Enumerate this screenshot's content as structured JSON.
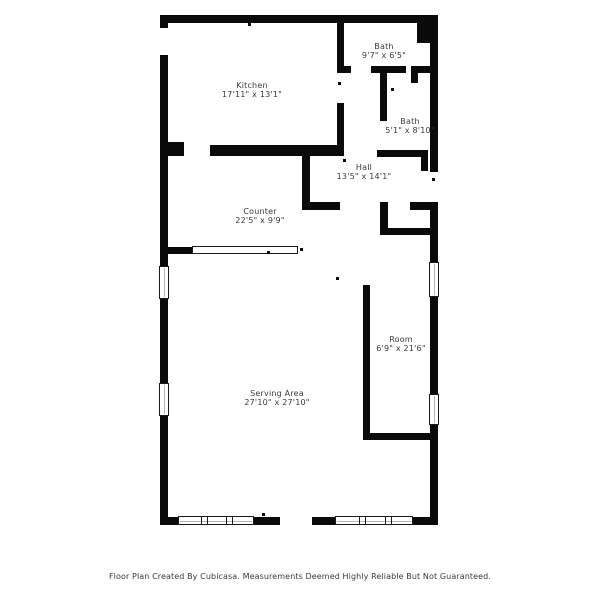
{
  "plan": {
    "rooms": [
      {
        "name": "Kitchen",
        "dims": "17'11\" x 13'1\""
      },
      {
        "name": "Bath",
        "dims": "9'7\" x 6'5\""
      },
      {
        "name": "Bath",
        "dims": "5'1\" x 8'10\""
      },
      {
        "name": "Hall",
        "dims": "13'5\" x 14'1\""
      },
      {
        "name": "Counter",
        "dims": "22'5\" x 9'9\""
      },
      {
        "name": "Room",
        "dims": "6'9\" x 21'6\""
      },
      {
        "name": "Serving Area",
        "dims": "27'10\" x 27'10\""
      }
    ],
    "colors": {
      "wall": "#0a0a0a",
      "background": "#ffffff",
      "text": "#3a3a3a"
    }
  },
  "footer": {
    "text": "Floor Plan Created By Cubicasa. Measurements Deemed Highly Reliable But Not Guaranteed."
  }
}
